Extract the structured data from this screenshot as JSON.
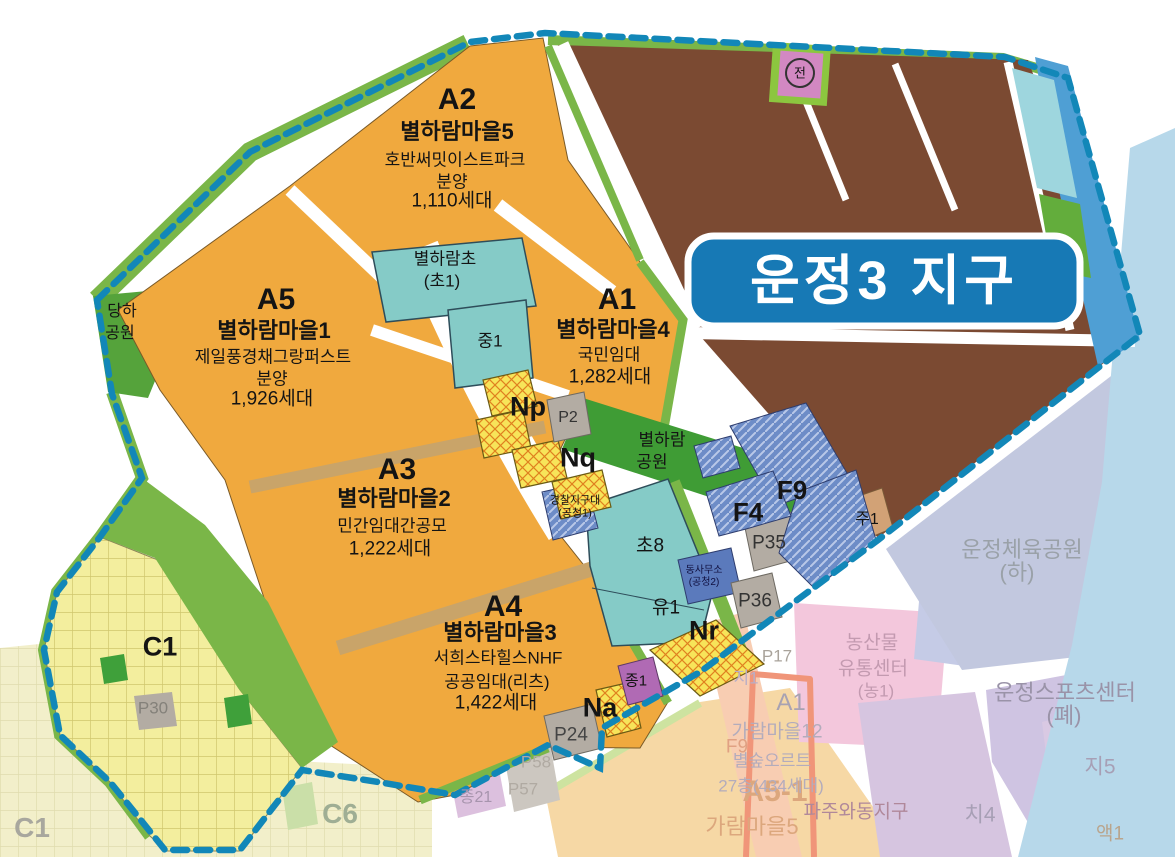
{
  "map": {
    "title": "운정3 지구",
    "jeon_marker": "전"
  },
  "blocks": {
    "a2": {
      "id": "A2",
      "village": "별하람마을5",
      "brand": "호반써밋이스트파크",
      "sale": "분양",
      "units": "1,110세대"
    },
    "a5": {
      "id": "A5",
      "village": "별하람마을1",
      "brand": "제일풍경채그랑퍼스트",
      "sale": "분양",
      "units": "1,926세대"
    },
    "a1": {
      "id": "A1",
      "village": "별하람마을4",
      "tenure": "국민임대",
      "units": "1,282세대"
    },
    "a3": {
      "id": "A3",
      "village": "별하람마을2",
      "tenure": "민간임대간공모",
      "units": "1,222세대"
    },
    "a4": {
      "id": "A4",
      "village": "별하람마을3",
      "brand": "서희스타힐스NHF",
      "tenure": "공공임대(리츠)",
      "units": "1,422세대"
    },
    "c1": {
      "id": "C1"
    }
  },
  "facilities": {
    "elementary": {
      "name": "별하람초",
      "code": "(초1)"
    },
    "middle": "중1",
    "cho8": "초8",
    "yu1": "유1",
    "police": {
      "name": "경찰지구대",
      "code": "(공청1)"
    },
    "office": {
      "name": "동사무소",
      "code": "(공청2)"
    }
  },
  "parks": {
    "danha": {
      "line1": "당하",
      "line2": "공원"
    },
    "byeolharam": {
      "line1": "별하람",
      "line2": "공원"
    }
  },
  "parcels": {
    "np": "Np",
    "nq": "Nq",
    "nr": "Nr",
    "na": "Na",
    "f4": "F4",
    "f9": "F9",
    "p2": "P2",
    "p24": "P24",
    "p30": "P30",
    "p35": "P35",
    "p36": "P36",
    "jong1": "종1",
    "ju1": "주1"
  },
  "surroundings": {
    "sports_park": {
      "line1": "운정체육공원",
      "line2": "(하)"
    },
    "sports_center": {
      "line1": "운정스포츠센터",
      "line2": "(폐)"
    },
    "agri_center": {
      "line1": "농산물",
      "line2": "유통센터",
      "line3": "(농1)"
    },
    "a5_1": {
      "id": "A5-1",
      "village": "가람마을5"
    },
    "wadong": "파주와동지구",
    "garam12": {
      "id": "A1",
      "village": "가람마을12",
      "brand": "별숲오르트",
      "units": "27층(434세대)"
    },
    "p17": "P17",
    "ji1": "지1",
    "f9": "F9",
    "p57": "P57",
    "p58": "P58",
    "jong21": "종21",
    "c1": "C1",
    "c6": "C6",
    "ji5": "지5",
    "chi4": "치4",
    "aek1": "액1"
  },
  "colors": {
    "boundary": "#1287b8",
    "residential_orange": "#f0a93e",
    "reserve_brown": "#7b4a32",
    "park_green": "#3f9c35",
    "school_teal": "#85cbc7",
    "commercial_yellow": "#f7e459",
    "f_blue": "#6d8cc7",
    "title_blue": "#1779b5",
    "water": "#4f9fd4"
  }
}
